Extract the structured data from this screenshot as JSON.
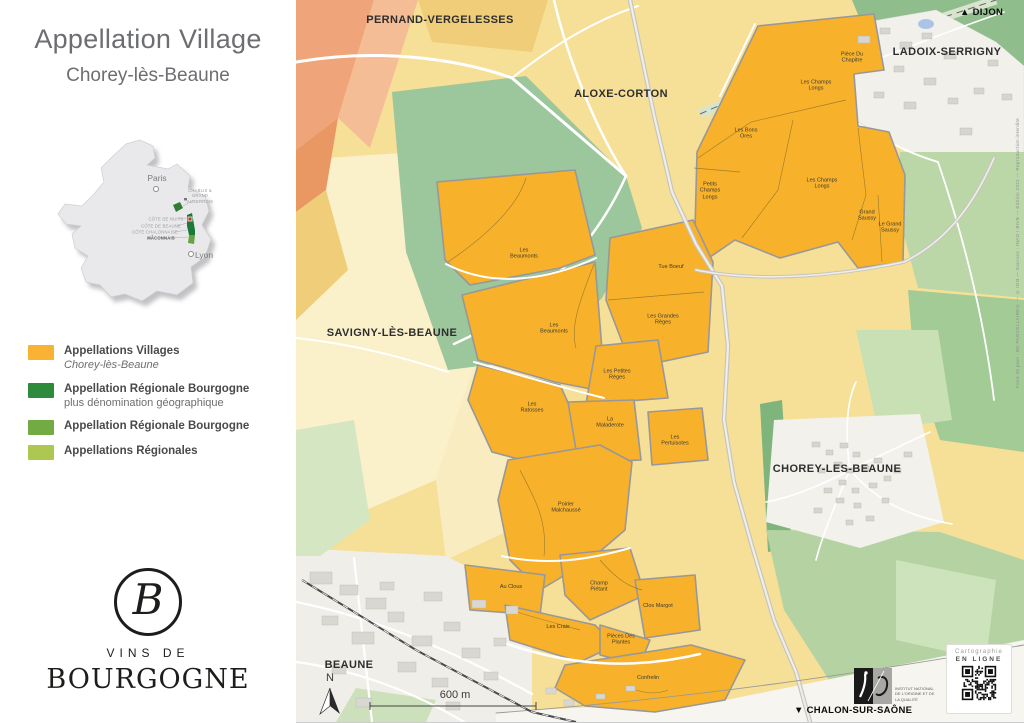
{
  "sidebar": {
    "title": "Appellation Village",
    "subtitle": "Chorey-lès-Beaune",
    "france": {
      "cities": [
        {
          "name": "Paris",
          "x": 101,
          "y": 42,
          "dot_x": 100,
          "dot_y": 53
        },
        {
          "name": "Lyon",
          "x": 148,
          "y": 119,
          "dot_x": 135,
          "dot_y": 118
        }
      ],
      "regions": [
        {
          "name": "CHABLIS &\nGRAND AUXERROIS",
          "x": 144,
          "y": 60,
          "bold": false
        },
        {
          "name": "CÔTE DE NUITS",
          "x": 110,
          "y": 83,
          "bold": false
        },
        {
          "name": "CÔTE DE BEAUNE",
          "x": 105,
          "y": 90,
          "bold": false
        },
        {
          "name": "CÔTE CHALONNAISE",
          "x": 99,
          "y": 96,
          "bold": false
        },
        {
          "name": "MÂCONNAIS",
          "x": 105,
          "y": 102,
          "bold": true
        }
      ]
    },
    "legend": [
      {
        "color": "#F9B233",
        "label": "Appellations Villages",
        "sublabel": "Chorey-lès-Beaune",
        "sublabel_italic": true
      },
      {
        "color": "#2E8B3D",
        "label": "Appellation Régionale Bourgogne",
        "sublabel": "plus dénomination géographique",
        "sublabel_italic": false
      },
      {
        "color": "#72AB44",
        "label": "Appellation Régionale Bourgogne",
        "sublabel": "",
        "sublabel_italic": false
      },
      {
        "color": "#ADC850",
        "label": "Appellations Régionales",
        "sublabel": "",
        "sublabel_italic": false
      }
    ],
    "logo": {
      "monogram": "B",
      "line1": "VINS DE",
      "line2": "BOURGOGNE"
    }
  },
  "map": {
    "place_labels": [
      {
        "name": "PERNAND-VERGELESSES",
        "x": 144,
        "y": 20
      },
      {
        "name": "ALOXE-CORTON",
        "x": 325,
        "y": 94
      },
      {
        "name": "LADOIX-SERRIGNY",
        "x": 651,
        "y": 52
      },
      {
        "name": "SAVIGNY-LÈS-BEAUNE",
        "x": 96,
        "y": 333
      },
      {
        "name": "CHOREY-LES-BEAUNE",
        "x": 541,
        "y": 469
      },
      {
        "name": "BEAUNE",
        "x": 53,
        "y": 665
      }
    ],
    "direction_markers": [
      {
        "arrow": "▲",
        "name": "DIJON",
        "x": 664,
        "y": 7
      },
      {
        "arrow": "▼",
        "name": "CHALON-SUR-SAÔNE",
        "x": 498,
        "y": 705
      }
    ],
    "parcel_labels": [
      {
        "text": "Les Champs\nLongs",
        "x": 520,
        "y": 86
      },
      {
        "text": "Pièce Du\nChapitre",
        "x": 556,
        "y": 58
      },
      {
        "text": "Les Bons\nOres",
        "x": 450,
        "y": 134
      },
      {
        "text": "Petits\nChamps\nLongs",
        "x": 414,
        "y": 191
      },
      {
        "text": "Les Champs\nLongs",
        "x": 526,
        "y": 184
      },
      {
        "text": "Grand\nSaussy",
        "x": 571,
        "y": 216
      },
      {
        "text": "Le Grand\nSaussy",
        "x": 594,
        "y": 228
      },
      {
        "text": "Les\nBeaumonts",
        "x": 228,
        "y": 254
      },
      {
        "text": "Les\nBeaumonts",
        "x": 258,
        "y": 329
      },
      {
        "text": "Tue Boeuf",
        "x": 375,
        "y": 267
      },
      {
        "text": "Les Grandes\nRèges",
        "x": 367,
        "y": 320
      },
      {
        "text": "Les Petites\nRèges",
        "x": 321,
        "y": 375
      },
      {
        "text": "La\nMaladerote",
        "x": 314,
        "y": 423
      },
      {
        "text": "Les\nPertuisotes",
        "x": 379,
        "y": 441
      },
      {
        "text": "Les\nRatosses",
        "x": 236,
        "y": 408
      },
      {
        "text": "Poirier\nMalchaussé",
        "x": 270,
        "y": 508
      },
      {
        "text": "Au Clous",
        "x": 215,
        "y": 587
      },
      {
        "text": "Champ\nPiétant",
        "x": 303,
        "y": 587
      },
      {
        "text": "Clos Margot",
        "x": 362,
        "y": 606
      },
      {
        "text": "Les Crais",
        "x": 262,
        "y": 627
      },
      {
        "text": "Pièces Des\nPlantes",
        "x": 325,
        "y": 640
      },
      {
        "text": "Confrelin",
        "x": 352,
        "y": 678
      }
    ],
    "scale_bar_label": "600 m",
    "north_label": "N",
    "cartouche": {
      "line1": "Cartographie",
      "line2": "EN LIGNE"
    },
    "inao_caption": "Institut National\nde l'Origine et de\nla Qualité",
    "credits_vertical": "Fond de plan : BD PARCELLAIRE® — © IGN — Sources : INAO / BIVB — Édition 2021 — Reproduction interdite"
  },
  "colors": {
    "appellation_village": "#F8B12A",
    "regional_bourgogne_denomination": "#2E8B3D",
    "regional_bourgogne": "#72AB44",
    "regionales": "#ADC850"
  }
}
